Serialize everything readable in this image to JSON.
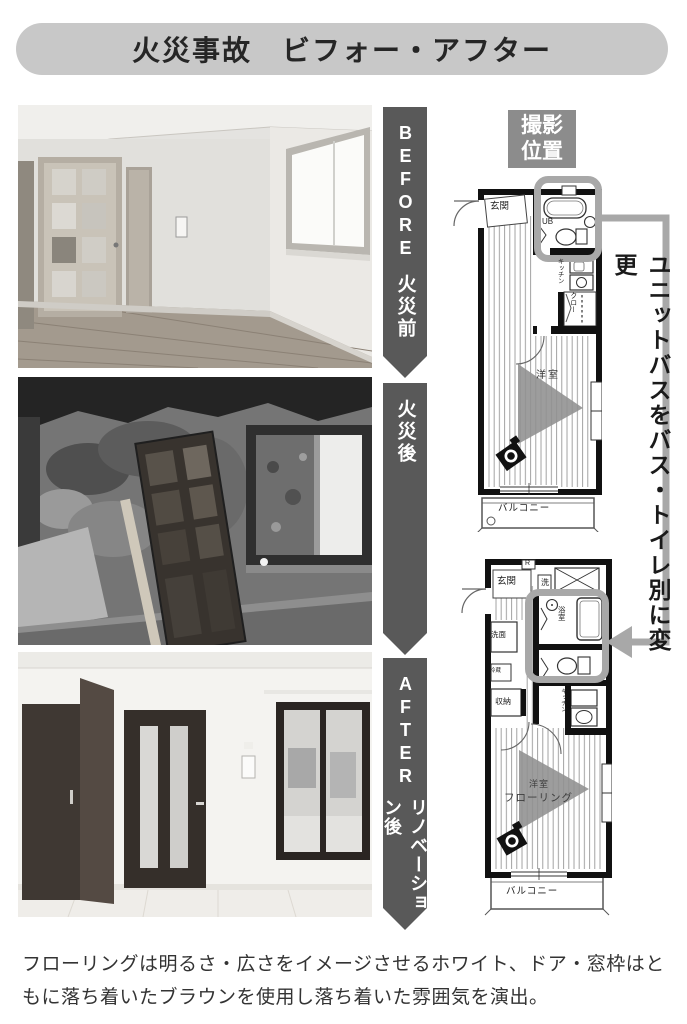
{
  "title": "火災事故　ビフォー・アフター",
  "arrows": {
    "before": {
      "en": "BEFORE",
      "ja": "火災前"
    },
    "fire": {
      "ja": "火災後"
    },
    "after": {
      "en": "AFTER",
      "ja": "リノベーション後"
    }
  },
  "camera_label": "撮影位置",
  "note": "ユニットバスをバス・トイレ別に変更",
  "fp1": {
    "entrance": "玄関",
    "unit_bath": "UB",
    "kitchen": "キッチン",
    "closet": "クロー",
    "room": "洋室",
    "balcony": "バルコニー"
  },
  "fp2": {
    "entrance": "玄関",
    "meter": "R",
    "laundry": "洗",
    "bath": "浴室",
    "wash": "洗面",
    "fridge": "冷蔵",
    "storage": "収納",
    "kitchen": "キッチン",
    "room": "洋室",
    "flooring": "フローリング",
    "balcony": "バルコニー"
  },
  "caption": {
    "line1": "フローリングは明るさ・広さをイメージさせるホワイト、ドア・窓枠はと",
    "line2": "もに落ち着いたブラウンを使用し落ち着いた雰囲気を演出。"
  },
  "colors": {
    "title_bar": "#c8c8c8",
    "arrow_banner": "#595959",
    "camera_box": "#8c8c8c",
    "highlight": "#a8a8a8"
  }
}
